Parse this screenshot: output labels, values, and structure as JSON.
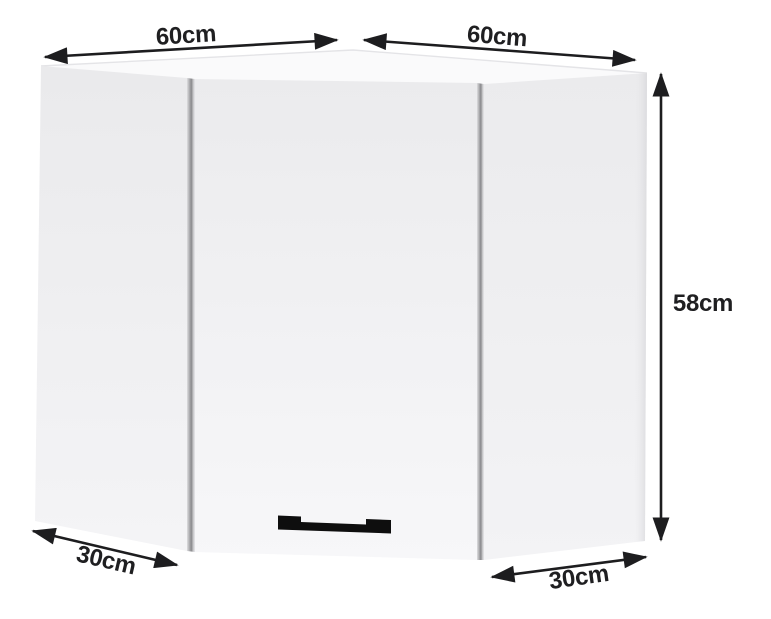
{
  "diagram": {
    "type": "corner-wall-cabinet-dimension-diagram",
    "colors": {
      "background": "#ffffff",
      "arrow": "#1d1d1f",
      "label_text": "#1f1f21",
      "cabinet_face": "#ececee",
      "cabinet_face_light": "#f7f7f9",
      "cabinet_top_face": "#fafafb",
      "seam_shadow": "#89898c",
      "handle": "#0e0e0e"
    }
  },
  "dimensions": {
    "top_left_width": "60cm",
    "top_right_width": "60cm",
    "height": "58cm",
    "left_depth": "30cm",
    "right_depth": "30cm"
  }
}
